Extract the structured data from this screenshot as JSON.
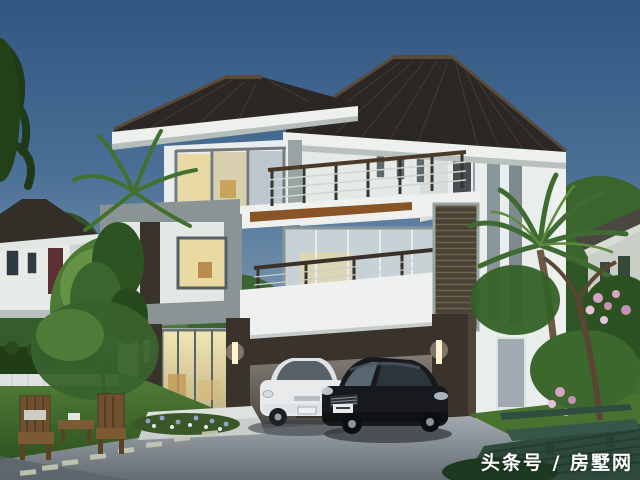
{
  "meta": {
    "kind": "3D architectural rendering",
    "description": "Modern three-storey white villa at dusk with charcoal hip roofs, roof terrace, balcony, wooden louver screen, lit interiors, carport with two cars, tropical garden and neighbouring houses"
  },
  "watermark": {
    "text": "头条号 / 房墅网"
  },
  "scene": {
    "main_house": {
      "storeys": 3,
      "features": [
        "hip roof",
        "roof terrace with railing",
        "second-floor balcony with white parapet",
        "wood trim ledge",
        "wooden louver screen",
        "glazed stairwell windows",
        "carport",
        "entrance glass doors with wall sconces",
        "warm lit interior windows"
      ]
    },
    "vehicles": [
      {
        "type": "hatchback",
        "color_name": "white"
      },
      {
        "type": "sedan",
        "color_name": "black"
      }
    ],
    "garden": [
      "lawn",
      "clipped hedge with low white fence",
      "stepping stones",
      "flower bed",
      "wooden patio chairs and table",
      "green timber deck with bench table",
      "palm trees",
      "pink flowering tree"
    ],
    "neighbours": [
      "single-storey house with maroon door on the left",
      "house roof behind palms on the right"
    ]
  },
  "colors": {
    "sky_top": "#315680",
    "sky_horizon": "#b2bec4",
    "roof": "#2b2724",
    "roof_neighbor": "#332e28",
    "fascia": "#edf0ec",
    "wall": "#e9edeb",
    "wall_shade": "#cdd4d3",
    "gray_panel": "#8b9494",
    "parapet": "#eef1ee",
    "dark_wood": "#3a332b",
    "wood_trim": "#8a5526",
    "louver": "#4a4234",
    "glass_cool": "#c6d2d6",
    "glass_warm": "#e9d9a2",
    "hedge": "#213d18",
    "grass": "#47722f",
    "driveway": "#98a0a6",
    "deck_green": "#2e4a3c",
    "car_white": "#e8eaeb",
    "car_black": "#17191c",
    "door_maroon": "#5c3133",
    "flower_pink": "#d6a4c5",
    "lamp_glow": "#fff3cf"
  }
}
